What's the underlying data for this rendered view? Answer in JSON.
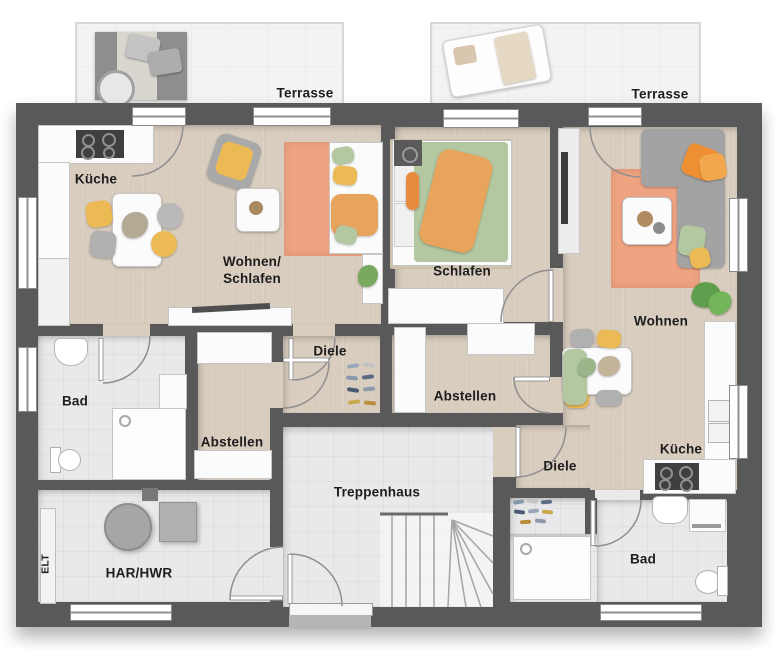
{
  "floorplan": {
    "rooms": [
      {
        "id": "terrasse-left",
        "label": "Terrasse"
      },
      {
        "id": "terrasse-right",
        "label": "Terrasse"
      },
      {
        "id": "kueche-left",
        "label": "Küche"
      },
      {
        "id": "wohnen-schlafen",
        "label": "Wohnen/Schlafen",
        "line1": "Wohnen/",
        "line2": "Schlafen"
      },
      {
        "id": "schlafen",
        "label": "Schlafen"
      },
      {
        "id": "wohnen",
        "label": "Wohnen"
      },
      {
        "id": "diele-left",
        "label": "Diele"
      },
      {
        "id": "abstellen-left",
        "label": "Abstellen"
      },
      {
        "id": "bad-left",
        "label": "Bad"
      },
      {
        "id": "abstellen-right",
        "label": "Abstellen"
      },
      {
        "id": "diele-right",
        "label": "Diele"
      },
      {
        "id": "kueche-right",
        "label": "Küche"
      },
      {
        "id": "bad-right",
        "label": "Bad"
      },
      {
        "id": "treppenhaus",
        "label": "Treppenhaus"
      },
      {
        "id": "har-hwr",
        "label": "HAR/HWR"
      },
      {
        "id": "elt",
        "label": "ELT"
      }
    ],
    "colors": {
      "wall": "#595959",
      "wood": "#d9cdbf",
      "tile": "#e9e9eb",
      "terrace": "#f3f3f3",
      "rug_orange": "#efa381",
      "rug_beige": "#d8ccb6",
      "accent_yellow": "#ecba55",
      "accent_green": "#b3c7a0",
      "accent_orange": "#e8a45c",
      "sofa_gray": "#a3a3a3",
      "counter_white": "#fbfbfb",
      "stove_dark": "#3f3f3f"
    }
  }
}
